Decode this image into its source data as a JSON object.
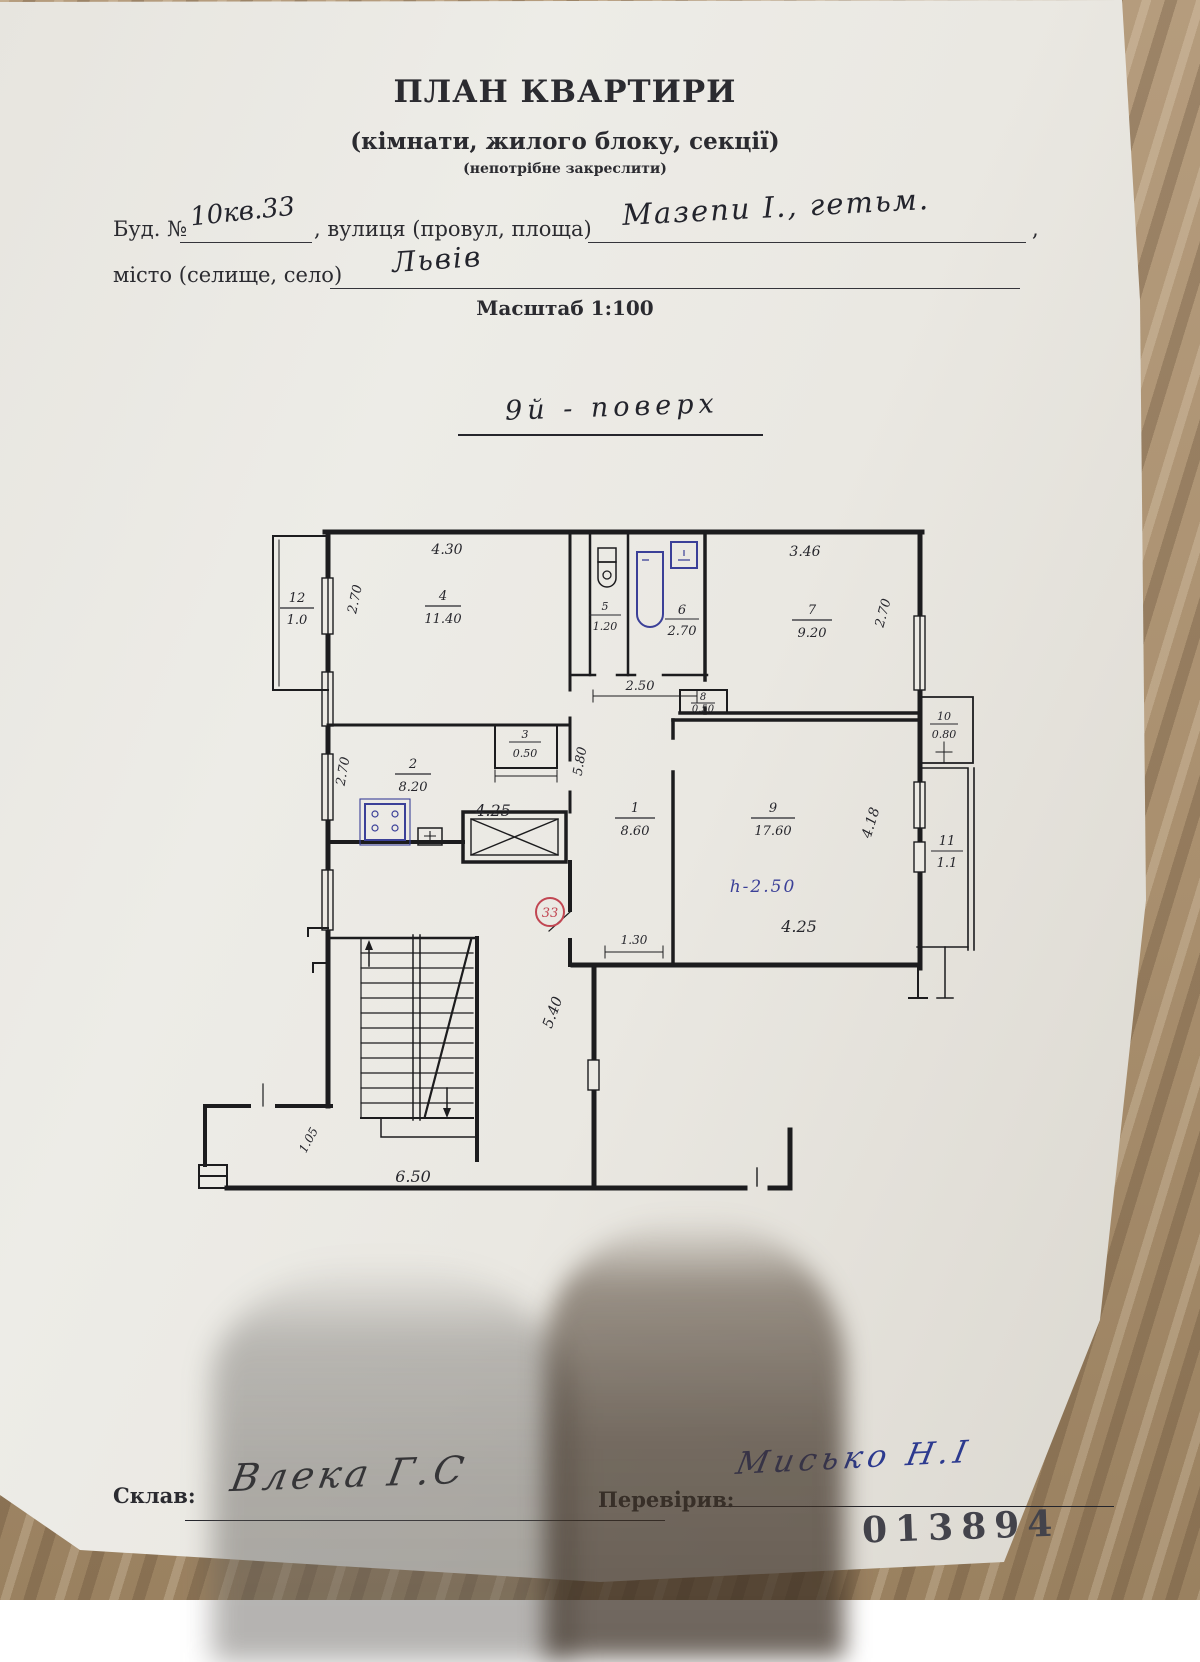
{
  "header": {
    "title": "ПЛАН КВАРТИРИ",
    "subtitle": "(кімнати, жилого блоку, секції)",
    "note": "(непотрібне закреслити)"
  },
  "form": {
    "building_label": "Буд. №",
    "building_value": "10кв.33",
    "street_label": ", вулиця (провул, площа)",
    "street_value": "Мазепи І., гетьм.",
    "street_comma": ",",
    "city_label": "місто (селище, село)",
    "city_value": "Львів",
    "scale": "Масштаб 1:100",
    "floor_note": "9й - поверх"
  },
  "plan": {
    "apartment_badge": "33",
    "height_note": "h-2.50",
    "rooms": {
      "r1": {
        "num": "1",
        "area": "8.60"
      },
      "r2": {
        "num": "2",
        "area": "8.20"
      },
      "r3": {
        "num": "3",
        "area": "0.50"
      },
      "r4": {
        "num": "4",
        "area": "11.40"
      },
      "r5": {
        "num": "5",
        "area": "1.20"
      },
      "r6": {
        "num": "6",
        "area": "2.70"
      },
      "r7": {
        "num": "7",
        "area": "9.20"
      },
      "r8": {
        "num": "8",
        "area": "0.50"
      },
      "r9": {
        "num": "9",
        "area": "17.60"
      },
      "r10": {
        "num": "10",
        "area": "0.80"
      },
      "r11": {
        "num": "11",
        "area": "1.1"
      },
      "r12": {
        "num": "12",
        "area": "1.0"
      }
    },
    "dims": {
      "room4_width": "4.30",
      "room4_depth": "2.70",
      "room2_depth": "2.70",
      "room2_width": "4.25",
      "room7_width": "3.46",
      "room7_depth": "2.70",
      "bath_row": "2.50",
      "hall_depth": "5.80",
      "room9_depth": "4.18",
      "room9_width": "4.25",
      "hall_bottom": "1.30",
      "stair_depth": "5.40",
      "entry_width": "6.50",
      "entry_side": "1.05"
    }
  },
  "footer": {
    "made_label": "Склав:",
    "made_signature": "Влека Г.С",
    "checked_label": "Перевірив:",
    "checked_signature": "Мисько Н.І",
    "stamp_number": "013894"
  }
}
